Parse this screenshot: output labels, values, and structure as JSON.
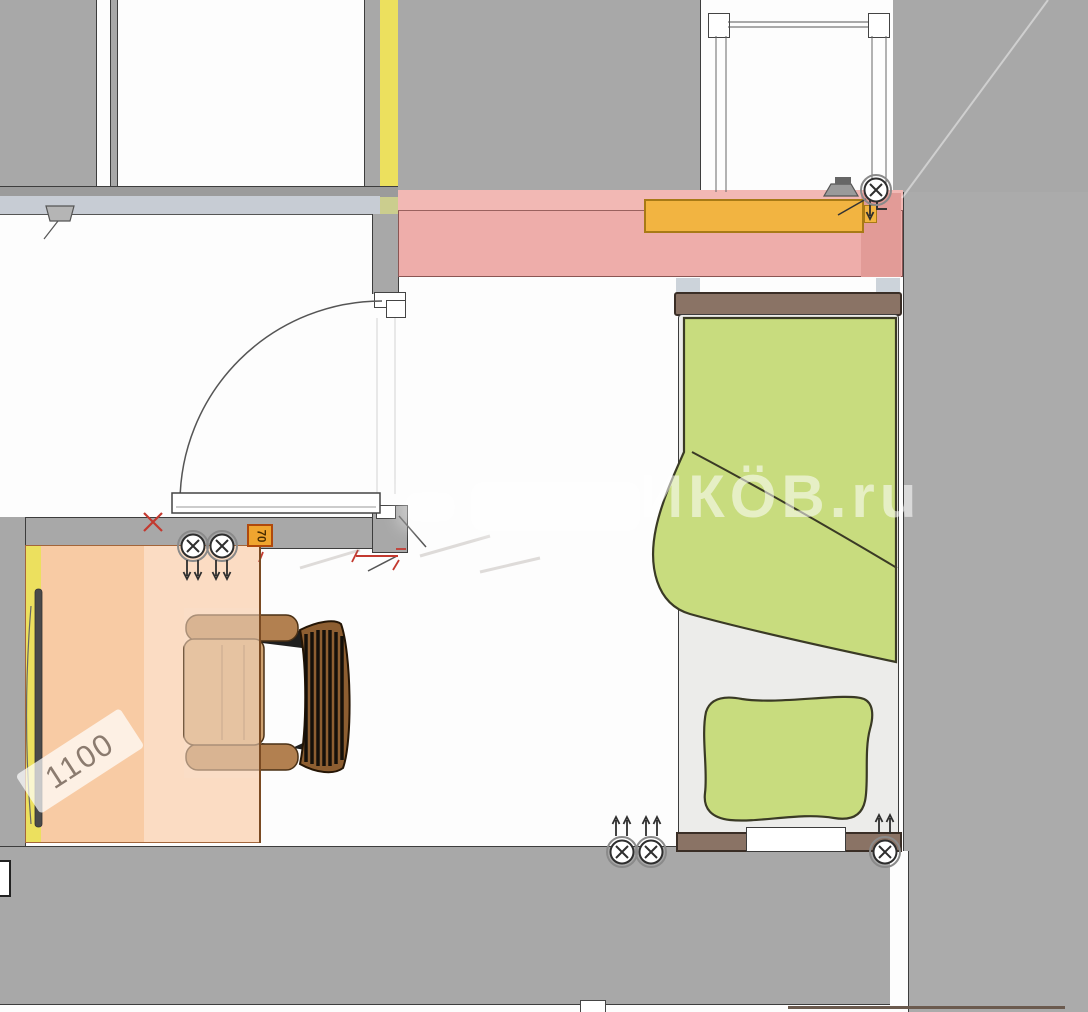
{
  "meta": {
    "type": "interior floor plan",
    "app": "room layout drawing"
  },
  "watermark": {
    "text": "ИКÖВ.ru"
  },
  "labels": {
    "desk_dimension": "1100",
    "spot_size": "70"
  },
  "symbols": {
    "ceiling_light": "circle-with-x",
    "ceiling_light_count": 6,
    "airflow_arrow_pairs": 5,
    "window": "double-line with end blocks",
    "door": "quarter-circle swing arc"
  },
  "furniture": {
    "bed": "single bed with green blanket and pillow, brown head/foot boards",
    "chair": "wooden slat-back armchair at desk",
    "desk": "peach highlighted desk zone with TV on left wall",
    "radiator": "orange radiator in pink window zone"
  },
  "colors": {
    "floor": "#fdfdfd",
    "wall": "#a8a8a8",
    "wall_light": "#ababab",
    "wall_outline": "#3d3d3d",
    "sill_band": "#c7ccd4",
    "desk_yellow": "#ece05e",
    "yellow_green": "#cbcd8e",
    "zone_pink": "#eeadaa",
    "zone_pink_light": "#f2b8b4",
    "zone_pink_dark": "#e29b97",
    "radiator_orange": "#f2b441",
    "radiator_border": "#a87a16",
    "bed_green": "#c8dc7e",
    "green_outline": "#3a3a25",
    "bed_frame_brown": "#8a7365",
    "mattress_white": "#ececea",
    "desk_peach_dark": "#f8cba4",
    "desk_peach_light": "#fbdcc3",
    "chair_brown": "#8d5e31",
    "chair_seat": "#cfa372",
    "chair_arm": "#b28050",
    "mark_red": "#c3392f",
    "spot_orange": "#f0a52f",
    "blue_stub": "#ccd3da"
  }
}
